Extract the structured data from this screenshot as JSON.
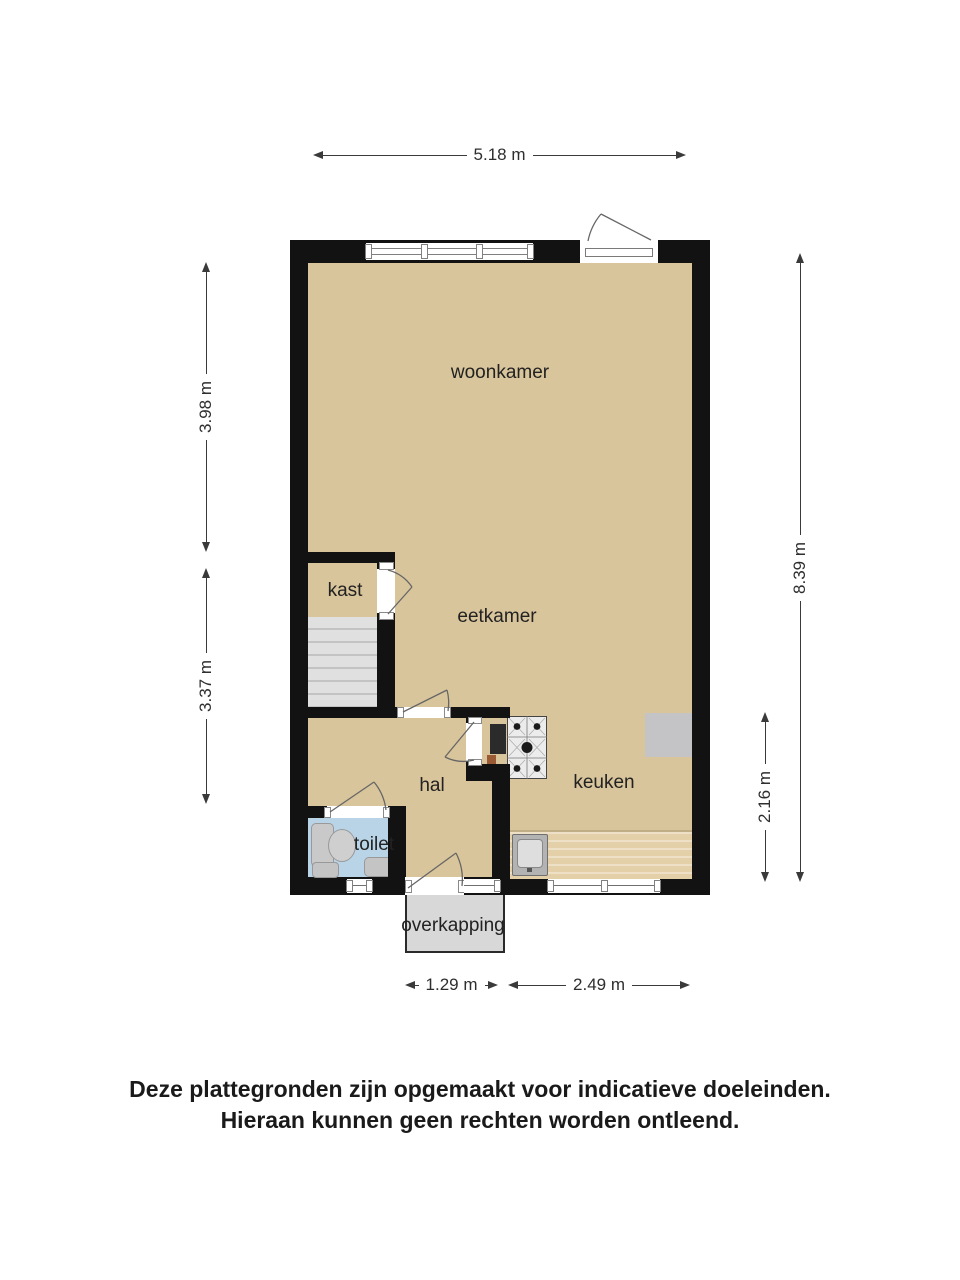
{
  "plan": {
    "rooms": {
      "woonkamer": "woonkamer",
      "eetkamer": "eetkamer",
      "kast": "kast",
      "hal": "hal",
      "toilet": "toilet",
      "keuken": "keuken",
      "overkapping": "overkapping"
    },
    "dimensions": {
      "top_width": "5.18 m",
      "left_upper": "3.98 m",
      "left_lower": "3.37 m",
      "right_full": "8.39 m",
      "right_lower": "2.16 m",
      "bottom_door": "1.29 m",
      "bottom_kitchen": "2.49 m"
    },
    "colors": {
      "wall": "#121212",
      "floor": "#d9c59b",
      "toilet_floor": "#b9d4e7",
      "stairs": "#e0e0e0",
      "counter": "#e3d0a8",
      "canopy": "#d8d8d8"
    }
  },
  "disclaimer": {
    "line1": "Deze plattegronden zijn opgemaakt voor indicatieve doeleinden.",
    "line2": "Hieraan kunnen geen rechten worden ontleend."
  }
}
